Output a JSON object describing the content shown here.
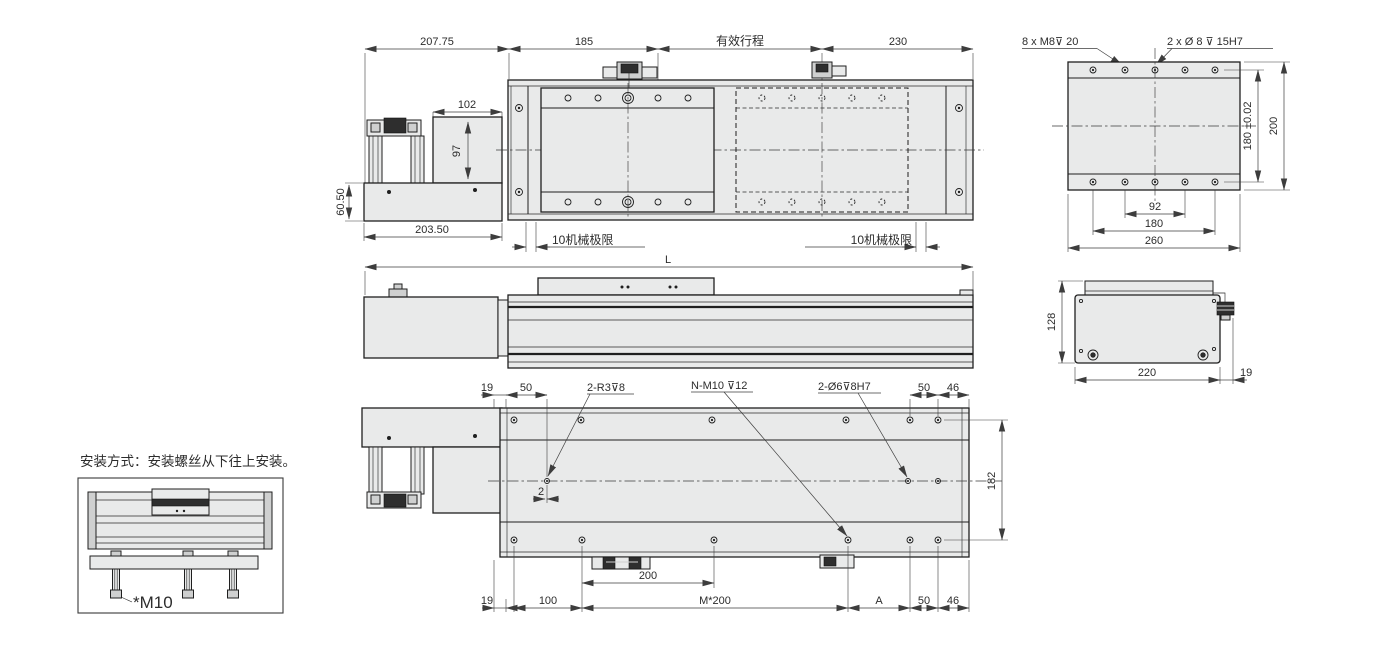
{
  "drawing": {
    "style": {
      "part_fill": "#e9eaea",
      "line_color": "#1f1f1f",
      "dim_color": "#3d3d3d"
    },
    "top_view": {
      "d_left": "207.75",
      "d_185": "185",
      "d_stroke": "有效行程",
      "d_230": "230",
      "d_102": "102",
      "d_97": "97",
      "d_6050": "60.50",
      "d_20350": "203.50",
      "limit_left": "10机械极限",
      "limit_right": "10机械极限"
    },
    "plate_view": {
      "callout_m8": "8 x  M8⊽ 20",
      "callout_dowel": "2 x  Ø 8 ⊽ 15H7",
      "d_180tol": "180 ±0.02",
      "d_200": "200",
      "d_92": "92",
      "d_180": "180",
      "d_260": "260"
    },
    "front_view": {
      "d_L": "L"
    },
    "end_view": {
      "d_128": "128",
      "d_220": "220",
      "d_19": "19"
    },
    "bottom_view": {
      "d_19_top": "19",
      "d_50_top": "50",
      "callout_r3": "2-R3⊽8",
      "callout_m10": "N-M10 ⊽12",
      "callout_dowel": "2-Ø6⊽8H7",
      "d_50_top_r": "50",
      "d_46_top": "46",
      "d_2": "2",
      "d_200": "200",
      "d_19_bot": "19",
      "d_100": "100",
      "d_m200": "M*200",
      "d_A": "A",
      "d_50_bot": "50",
      "d_46_bot": "46",
      "d_182": "182"
    },
    "inset": {
      "title": "安装方式：安装螺丝从下往上安装。",
      "bolt": "*M10"
    }
  }
}
